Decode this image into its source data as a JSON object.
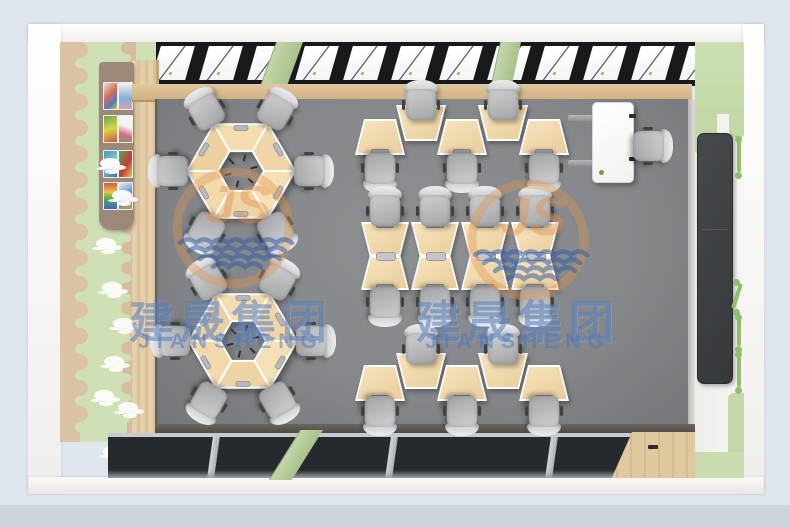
{
  "meta": {
    "description": "Top-down 3D render of a kindergarten classroom furniture layout",
    "room": "classroom"
  },
  "watermark": {
    "company_cn": "建晟集团",
    "company_en": "JIANSHENG",
    "monogram": "JS",
    "cn_color": "rgba(74,118,188,0.52)",
    "en_color": "rgba(74,118,188,0.50)",
    "ring_color": "rgba(224,149,79,0.38)",
    "js_color": "rgba(224,144,80,0.42)",
    "wave_color": "rgba(47,92,168,0.52)",
    "instances": [
      {
        "cx": 233,
        "ring_cy": 228,
        "text_cx": 231,
        "text_top": 286
      },
      {
        "cx": 528,
        "ring_cy": 240,
        "text_cx": 518,
        "text_top": 286
      }
    ]
  },
  "palette": {
    "background": "#e0e6ee",
    "floor": "#85878a",
    "desk_wood": "#eed2a2",
    "wall_green": "#cfe0b6",
    "window_dark": "#17191d",
    "green_post": "#b2c996",
    "blackboard": "#3c3f42"
  },
  "scene": {
    "top_window_panes": 13,
    "top_green_posts": [
      {
        "x": 276,
        "w": 26,
        "skew": -20
      },
      {
        "x": 500,
        "w": 20,
        "skew": -12
      }
    ],
    "bottom_frames_x": [
      210,
      388,
      548,
      642
    ],
    "clouds": [
      [
        100,
        158
      ],
      [
        112,
        190
      ],
      [
        96,
        238
      ],
      [
        102,
        282
      ],
      [
        113,
        318
      ],
      [
        104,
        356
      ],
      [
        94,
        390
      ],
      [
        118,
        402
      ],
      [
        103,
        446
      ],
      [
        128,
        458
      ]
    ],
    "artworks": 8,
    "hex_groups": [
      {
        "cx": 241,
        "cy": 171
      },
      {
        "cx": 243,
        "cy": 341
      }
    ],
    "hex_desks_per_group": 6,
    "hex_chairs_per_group": 6,
    "hex_chair_radius": 72,
    "zigzag_rows": [
      {
        "cx": 462,
        "desks": 5,
        "spacing": 41,
        "down_cy": 137,
        "up_cy": 123,
        "chair_top_cy": 101,
        "chair_bottom_cy": 172
      },
      {
        "cx": 462,
        "desks": 5,
        "spacing": 41,
        "down_cy": 383,
        "up_cy": 371,
        "chair_top_cy": 345,
        "chair_bottom_cy": 415
      }
    ],
    "bowtie": {
      "cols": [
        385,
        435,
        485,
        535
      ],
      "upper_cy": 239,
      "lower_cy": 273,
      "chair_top_cy": 207,
      "chair_bottom_cy": 306
    },
    "teacher_chair": {
      "cx": 652,
      "cy": 146,
      "rot": 90
    },
    "hole_marks_per_hex": 6
  }
}
